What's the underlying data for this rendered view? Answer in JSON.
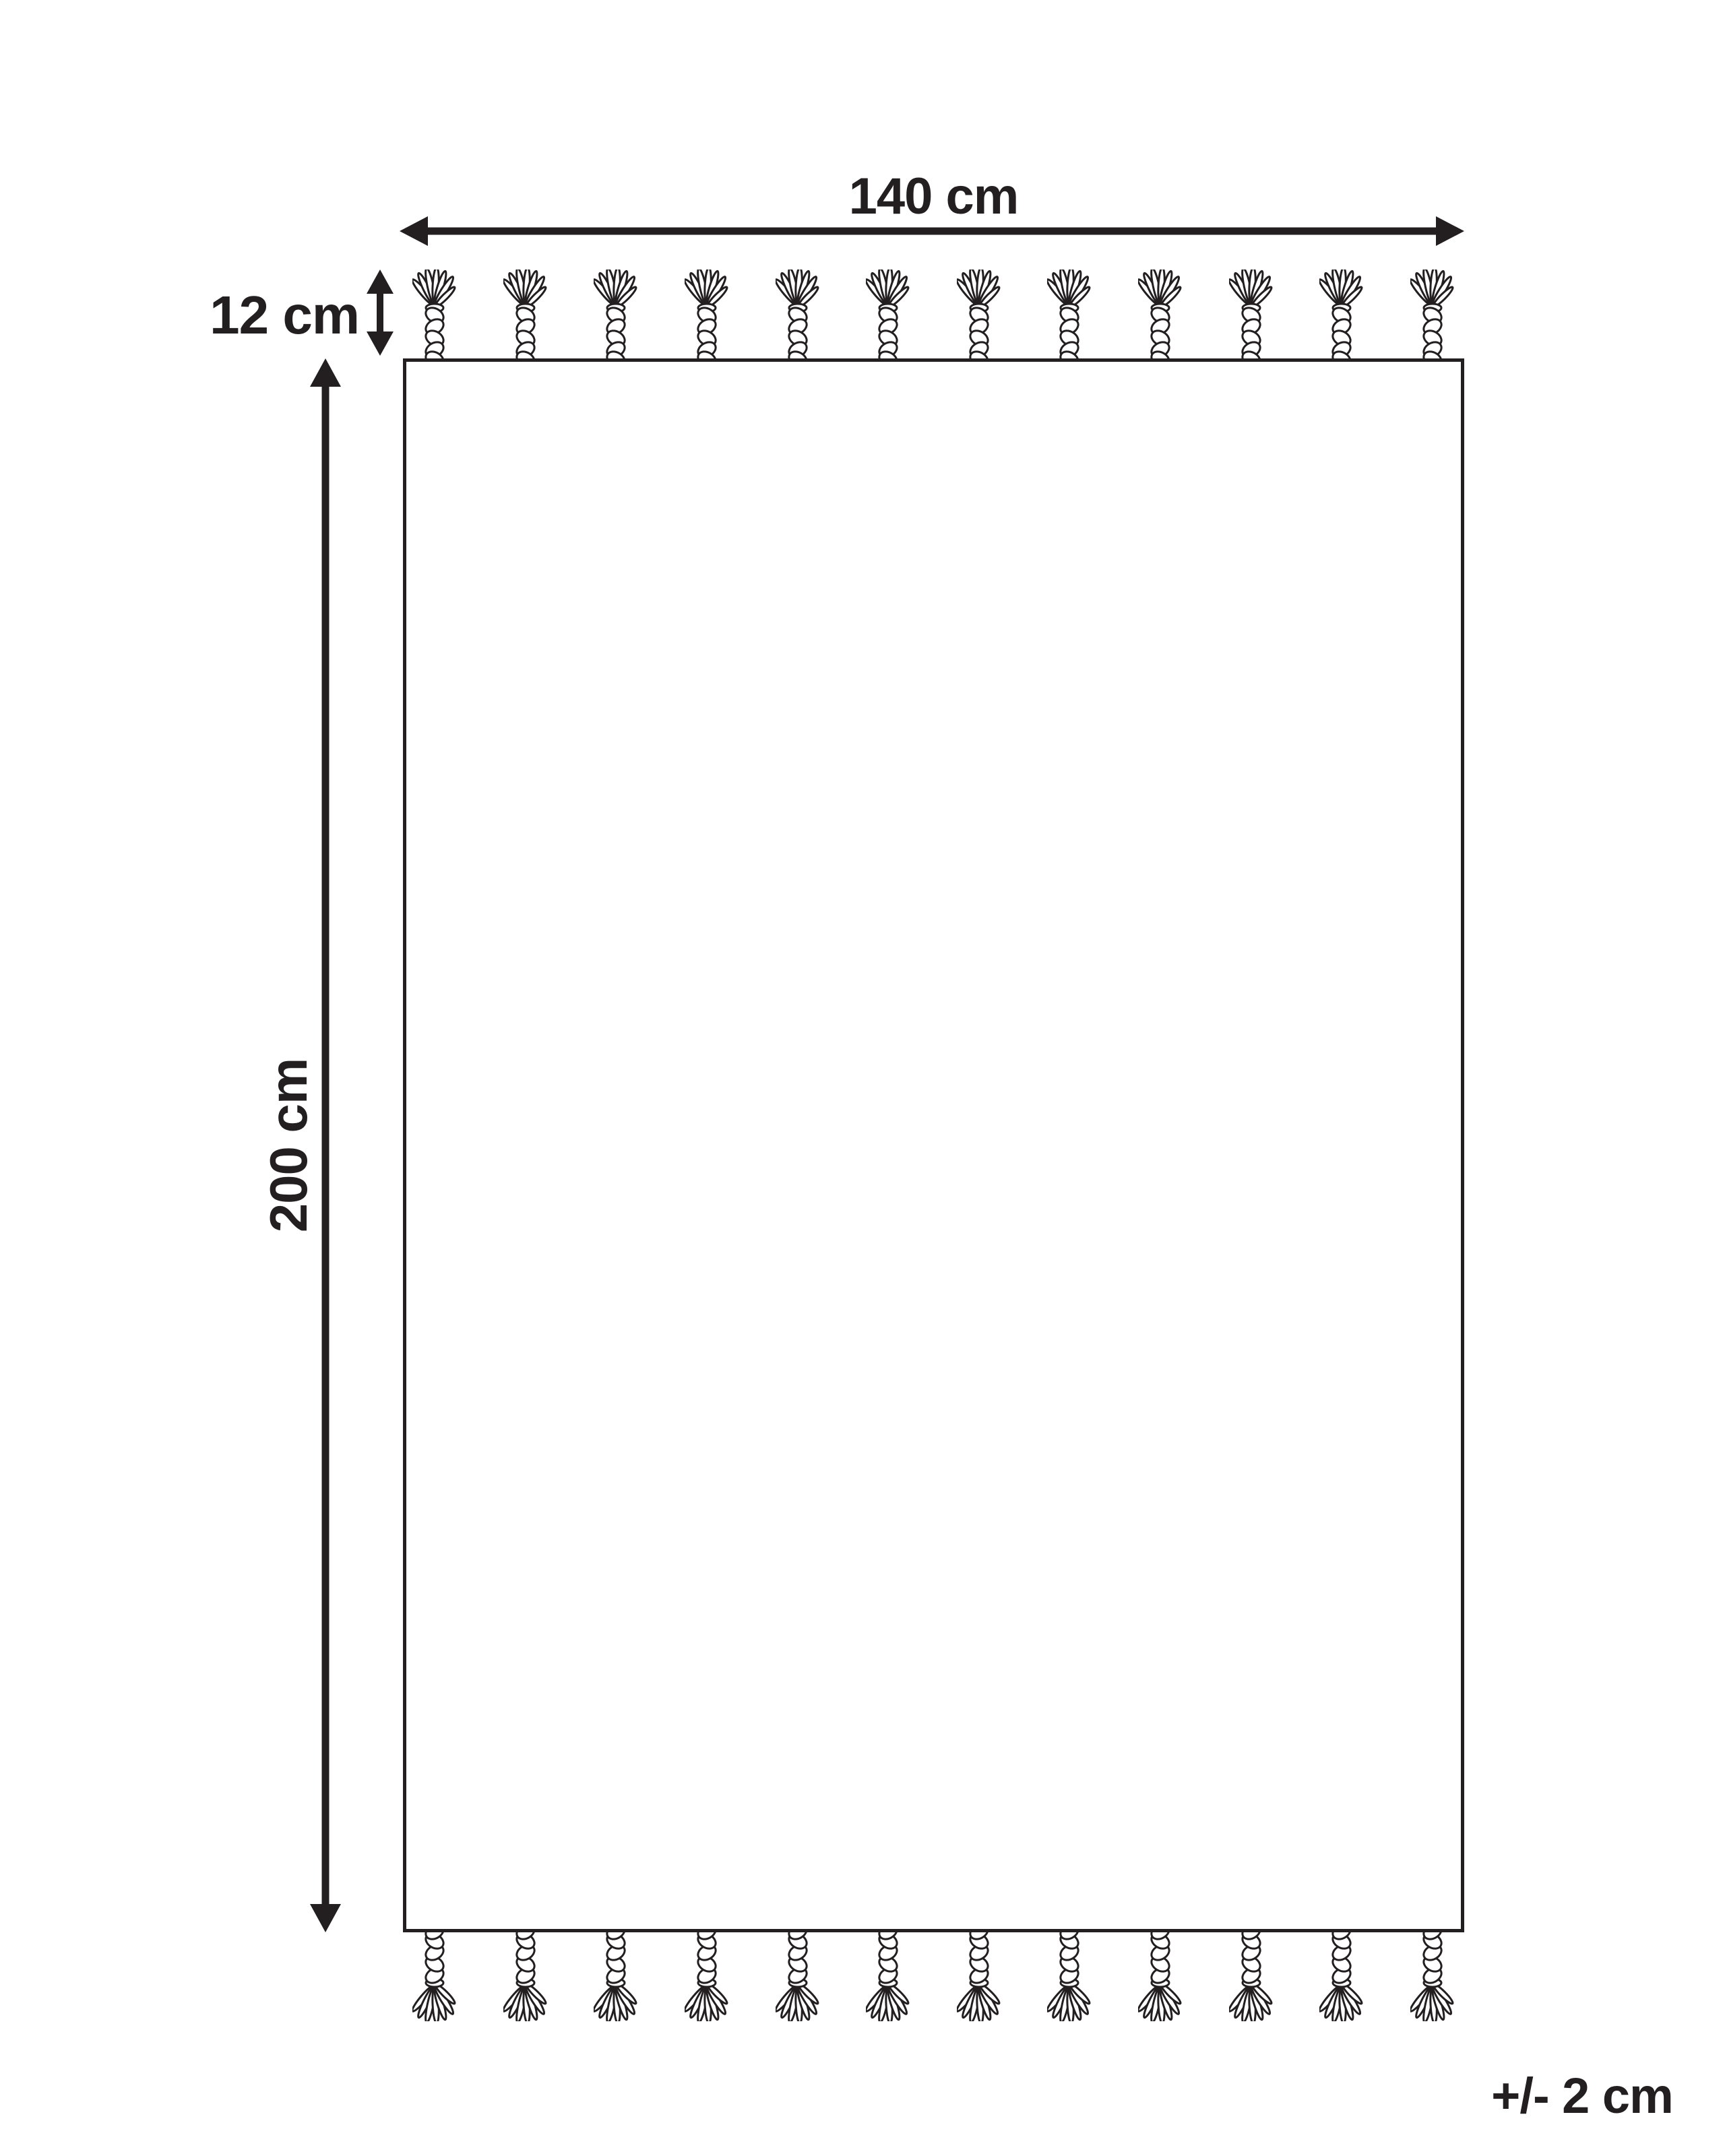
{
  "diagram": {
    "kind": "product-dimension-diagram",
    "product": "rug with tassels",
    "labels": {
      "width": "140 cm",
      "tassel_length": "12 cm",
      "height": "200 cm",
      "tolerance": "+/- 2 cm"
    },
    "tassels": {
      "per_row": 12,
      "rows": [
        "top",
        "bottom"
      ],
      "icon": "tassel-icon"
    },
    "arrows": {
      "width_arrow": "double-headed horizontal",
      "height_arrow": "double-headed vertical",
      "tassel_length_arrow": "double-headed vertical small"
    },
    "colors": {
      "ink": "#231f20",
      "background": "#ffffff"
    }
  }
}
